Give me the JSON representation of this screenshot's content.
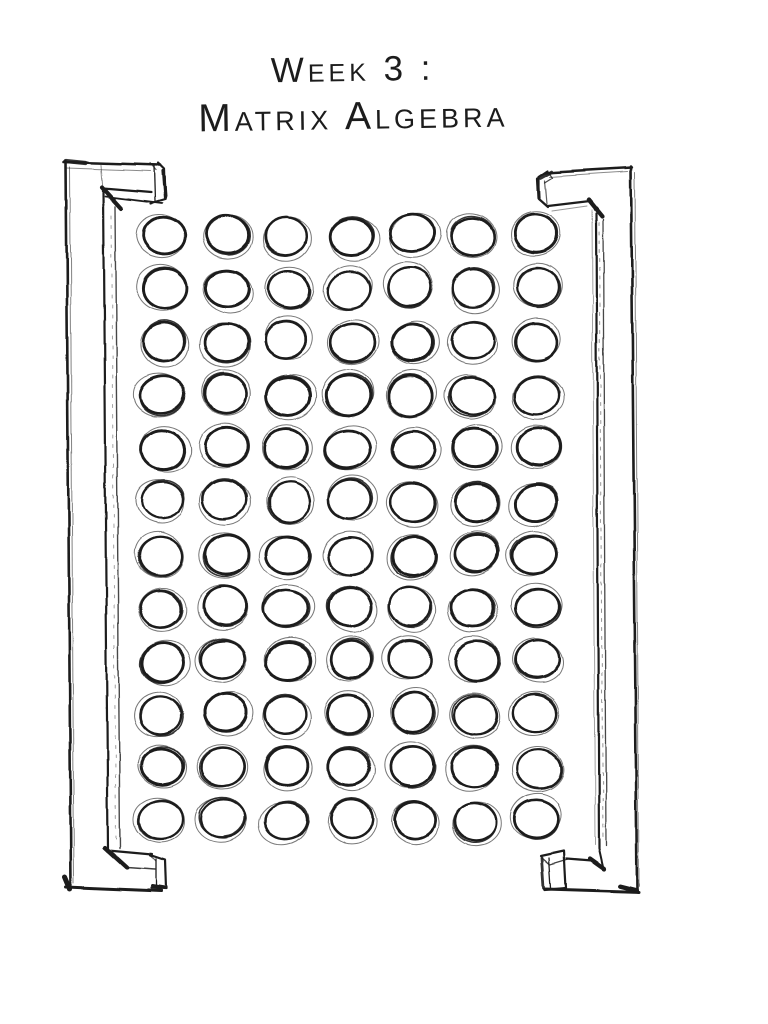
{
  "page": {
    "background": "#ffffff",
    "ink_color": "#1c1c1c"
  },
  "title": {
    "line1": "Week 3 :",
    "line2": "Matrix Algebra"
  },
  "illustration": {
    "type": "hand-drawn-matrix-sketch",
    "rows": 12,
    "columns": 7,
    "cells": 84,
    "brackets": [
      "left",
      "right"
    ]
  }
}
